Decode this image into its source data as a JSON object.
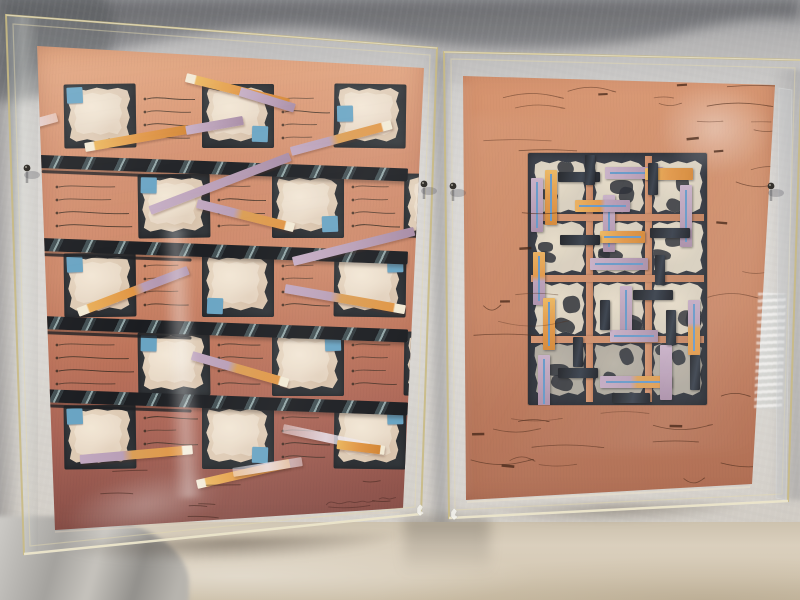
{
  "scene": {
    "type": "photograph",
    "subject": "Two mixed-media collage artworks on salmon handmade paper, each in a clear acrylic box frame, standing on a table against a light fabric backdrop",
    "palette": {
      "backdrop_shadow": "#6d6e72",
      "backdrop_fabric": "#d6d3ce",
      "table_surface": "#d6cbb8",
      "acrylic_edge": "#c9ba84",
      "left_paper_top": "#e2a178",
      "left_paper_mid": "#cd8666",
      "left_paper_low": "#a86051",
      "left_paper_bottom": "#7e4842",
      "right_paper_top": "#d69069",
      "right_paper_mid": "#c67f5c",
      "right_paper_bottom": "#aa6549",
      "patch_cream": "#ddc9b2",
      "patch_light": "#eedfca",
      "cell_dark": "#2b2f33",
      "bar_black": "#14161a",
      "blue_square": "#64a1c1",
      "strip_orange": "#e0923e",
      "strip_orange_tip": "#f2e9d3",
      "strip_lavender": "#b69bb4",
      "strip_pale": "#e9e3ec",
      "panel_bg": "#262b34",
      "panel_lattice": "#ca8560",
      "panel_blue_line": "#5d92c4",
      "ink_scribble": "#4e2e1e"
    }
  },
  "left_artwork": {
    "paper_corners": "37,46 424,68 403,508 55,530",
    "cell_w": 72,
    "cell_h": 64,
    "cells": [
      {
        "x": 64,
        "y": 84,
        "blue": "tl"
      },
      {
        "x": 202,
        "y": 84,
        "blue": "br"
      },
      {
        "x": 334,
        "y": 84,
        "blue": "lm"
      },
      {
        "x": 138,
        "y": 174,
        "blue": "tl"
      },
      {
        "x": 272,
        "y": 174,
        "blue": "br"
      },
      {
        "x": 404,
        "y": 174,
        "blue": ""
      },
      {
        "x": 64,
        "y": 253,
        "blue": "tl"
      },
      {
        "x": 202,
        "y": 253,
        "blue": "bl"
      },
      {
        "x": 334,
        "y": 253,
        "blue": "tr"
      },
      {
        "x": 138,
        "y": 332,
        "blue": "tl"
      },
      {
        "x": 272,
        "y": 332,
        "blue": "tr"
      },
      {
        "x": 404,
        "y": 332,
        "blue": ""
      },
      {
        "x": 64,
        "y": 405,
        "blue": "tl"
      },
      {
        "x": 202,
        "y": 405,
        "blue": "br"
      },
      {
        "x": 334,
        "y": 405,
        "blue": "tr"
      }
    ],
    "scribble_zones": [
      {
        "x": 140,
        "y": 92,
        "w": 58
      },
      {
        "x": 278,
        "y": 92,
        "w": 52
      },
      {
        "x": 52,
        "y": 180,
        "w": 82
      },
      {
        "x": 214,
        "y": 180,
        "w": 54
      },
      {
        "x": 348,
        "y": 180,
        "w": 52
      },
      {
        "x": 140,
        "y": 259,
        "w": 58
      },
      {
        "x": 278,
        "y": 259,
        "w": 52
      },
      {
        "x": 52,
        "y": 338,
        "w": 82
      },
      {
        "x": 214,
        "y": 338,
        "w": 54
      },
      {
        "x": 348,
        "y": 338,
        "w": 52
      },
      {
        "x": 140,
        "y": 411,
        "w": 58
      },
      {
        "x": 278,
        "y": 411,
        "w": 52
      }
    ],
    "bars": {
      "x": 40,
      "width": 368,
      "height": 13,
      "tilt_deg": 2.1,
      "ys": [
        155,
        238,
        316,
        389
      ]
    },
    "strips": [
      {
        "x": 186,
        "y": 73,
        "len": 106,
        "ang": 14,
        "kind": "orange",
        "tip": "start"
      },
      {
        "x": 240,
        "y": 87,
        "len": 57,
        "ang": 17,
        "kind": "lavender"
      },
      {
        "x": 291,
        "y": 147,
        "len": 104,
        "ang": -15,
        "kind": "lav-orange",
        "tip": "end"
      },
      {
        "x": 4,
        "y": 127,
        "len": 55,
        "ang": -15,
        "kind": "pale"
      },
      {
        "x": 85,
        "y": 143,
        "len": 104,
        "ang": -10,
        "kind": "orange",
        "tip": "start"
      },
      {
        "x": 186,
        "y": 126,
        "len": 58,
        "ang": -10,
        "kind": "lavender"
      },
      {
        "x": 150,
        "y": 206,
        "len": 150,
        "ang": -21,
        "kind": "lavender"
      },
      {
        "x": 197,
        "y": 199,
        "len": 100,
        "ang": 14,
        "kind": "lav-orange",
        "tip": "end"
      },
      {
        "x": 293,
        "y": 257,
        "len": 125,
        "ang": -14,
        "kind": "lavender"
      },
      {
        "x": 78,
        "y": 308,
        "len": 118,
        "ang": -21,
        "kind": "orange-lav",
        "tip": "start"
      },
      {
        "x": 285,
        "y": 284,
        "len": 122,
        "ang": 10,
        "kind": "lav-orange",
        "tip": "end"
      },
      {
        "x": 192,
        "y": 351,
        "len": 100,
        "ang": 16,
        "kind": "lav-orange",
        "tip": "end"
      },
      {
        "x": 283,
        "y": 424,
        "len": 88,
        "ang": 12,
        "kind": "pale"
      },
      {
        "x": 80,
        "y": 455,
        "len": 113,
        "ang": -5,
        "kind": "lav-orange",
        "tip": "end"
      },
      {
        "x": 197,
        "y": 480,
        "len": 95,
        "ang": -13,
        "kind": "orange",
        "tip": "start"
      },
      {
        "x": 233,
        "y": 468,
        "len": 70,
        "ang": -9,
        "kind": "pale"
      },
      {
        "x": 337,
        "y": 440,
        "len": 48,
        "ang": 7,
        "kind": "orange",
        "tip": "end"
      }
    ],
    "signature": {
      "x": 326,
      "y": 500
    },
    "extra_marks_region": {
      "x": 64,
      "y": 468,
      "w": 330,
      "h": 50,
      "n": 8
    }
  },
  "right_artwork": {
    "paper_corners": "463,76 775,85 752,484 466,500",
    "panel": {
      "x": 528,
      "y": 153,
      "w": 179,
      "h": 252,
      "cols": [
        534,
        593,
        652
      ],
      "rows": [
        160,
        221,
        282,
        343
      ],
      "cell_w": 52,
      "cell_h": 54,
      "lattice_v": [
        586,
        645
      ],
      "lattice_h": [
        214,
        275,
        336
      ],
      "lattice_t": 7
    },
    "strips": [
      {
        "x": 545,
        "y": 170,
        "len": 55,
        "dir": "v",
        "kind": "orange",
        "blue": true
      },
      {
        "x": 531,
        "y": 178,
        "len": 54,
        "dir": "v",
        "kind": "lavender",
        "blue": true
      },
      {
        "x": 605,
        "y": 167,
        "len": 58,
        "dir": "h",
        "kind": "lavender",
        "blue": true
      },
      {
        "x": 645,
        "y": 168,
        "len": 48,
        "dir": "h",
        "kind": "orange",
        "blue": false
      },
      {
        "x": 680,
        "y": 185,
        "len": 62,
        "dir": "v",
        "kind": "lavender",
        "blue": true
      },
      {
        "x": 603,
        "y": 195,
        "len": 57,
        "dir": "v",
        "kind": "lavender",
        "blue": true
      },
      {
        "x": 575,
        "y": 200,
        "len": 55,
        "dir": "h",
        "kind": "orange-lav",
        "blue": true
      },
      {
        "x": 533,
        "y": 252,
        "len": 53,
        "dir": "v",
        "kind": "orange-lav",
        "blue": true
      },
      {
        "x": 590,
        "y": 258,
        "len": 58,
        "dir": "h",
        "kind": "lavender",
        "blue": true
      },
      {
        "x": 600,
        "y": 231,
        "len": 45,
        "dir": "h",
        "kind": "orange",
        "blue": true
      },
      {
        "x": 620,
        "y": 286,
        "len": 54,
        "dir": "v",
        "kind": "lavender",
        "blue": true
      },
      {
        "x": 543,
        "y": 298,
        "len": 52,
        "dir": "v",
        "kind": "orange",
        "blue": true
      },
      {
        "x": 688,
        "y": 300,
        "len": 55,
        "dir": "v",
        "kind": "lav-orange",
        "blue": true
      },
      {
        "x": 610,
        "y": 330,
        "len": 48,
        "dir": "h",
        "kind": "lavender",
        "blue": true
      },
      {
        "x": 538,
        "y": 355,
        "len": 53,
        "dir": "v",
        "kind": "lavender",
        "blue": true
      },
      {
        "x": 600,
        "y": 376,
        "len": 72,
        "dir": "h",
        "kind": "lav-orange",
        "blue": true
      },
      {
        "x": 660,
        "y": 345,
        "len": 55,
        "dir": "v",
        "kind": "lavender",
        "blue": false
      }
    ],
    "black_bars": [
      {
        "x": 558,
        "y": 172,
        "len": 42,
        "dir": "h"
      },
      {
        "x": 585,
        "y": 155,
        "len": 30,
        "dir": "v"
      },
      {
        "x": 648,
        "y": 163,
        "len": 32,
        "dir": "v"
      },
      {
        "x": 650,
        "y": 228,
        "len": 40,
        "dir": "h"
      },
      {
        "x": 560,
        "y": 235,
        "len": 40,
        "dir": "h"
      },
      {
        "x": 655,
        "y": 255,
        "len": 30,
        "dir": "v"
      },
      {
        "x": 633,
        "y": 290,
        "len": 40,
        "dir": "h"
      },
      {
        "x": 600,
        "y": 300,
        "len": 30,
        "dir": "v"
      },
      {
        "x": 666,
        "y": 310,
        "len": 35,
        "dir": "v"
      },
      {
        "x": 573,
        "y": 337,
        "len": 30,
        "dir": "v"
      },
      {
        "x": 558,
        "y": 368,
        "len": 40,
        "dir": "h"
      },
      {
        "x": 690,
        "y": 355,
        "len": 35,
        "dir": "v"
      },
      {
        "x": 612,
        "y": 393,
        "len": 38,
        "dir": "h"
      }
    ],
    "scribble_regions": [
      {
        "x": 472,
        "y": 84,
        "w": 292,
        "h": 68,
        "n": 16
      },
      {
        "x": 470,
        "y": 155,
        "w": 56,
        "h": 245,
        "n": 7
      },
      {
        "x": 706,
        "y": 160,
        "w": 58,
        "h": 240,
        "n": 7
      },
      {
        "x": 470,
        "y": 405,
        "w": 280,
        "h": 75,
        "n": 15
      }
    ],
    "seed": 13
  },
  "frames": {
    "left": {
      "outer": "6,15 437,48 421,514 24,554",
      "inner": "13,24 430,55 415,507 30,546"
    },
    "right": {
      "outer": "444,52 802,60 788,501 449,518",
      "inner": "451,59 795,68 782,494 455,510",
      "side": "779,88 792,90 786,500 776,498"
    },
    "screws": [
      [
        27,
        168
      ],
      [
        424,
        184
      ],
      [
        453,
        186
      ],
      [
        771,
        186
      ]
    ],
    "paint_chips": [
      [
        417,
        508
      ],
      [
        451,
        512
      ]
    ]
  }
}
